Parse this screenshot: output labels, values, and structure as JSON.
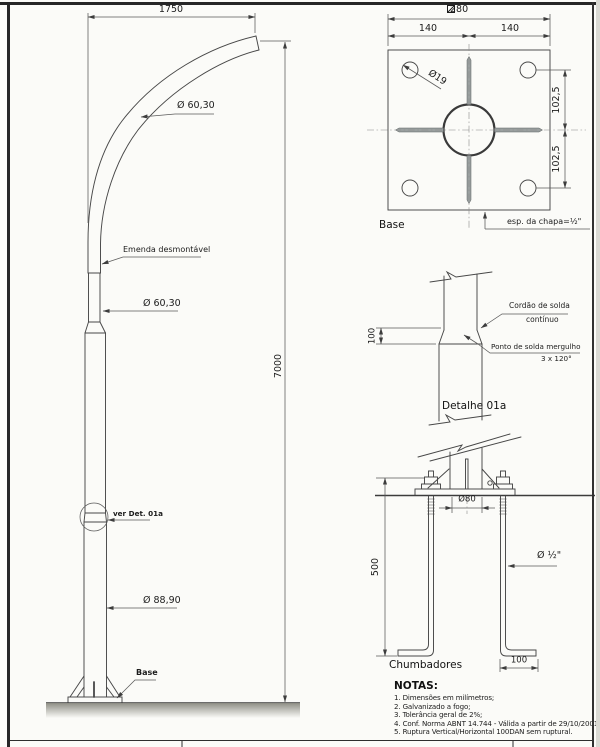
{
  "colors": {
    "line": "#474747",
    "text": "#1c1c1c",
    "slot_fill": "#9aa0a0",
    "paper": "#fbfbf8"
  },
  "pole_view": {
    "dim_width": "1750",
    "dim_height": "7000",
    "arm_diameter": "Ø 60,30",
    "splice_label": "Emenda desmontável",
    "shaft_diameter": "Ø 60,30",
    "detail_ref": "ver Det. 01a",
    "base_diameter": "Ø 88,90",
    "base_label": "Base"
  },
  "base_plate_view": {
    "title": "Base",
    "dim_square": "280",
    "dim_left_half": "140",
    "dim_right_half": "140",
    "hole_diameter": "Ø19",
    "dim_upper_spacing": "102,5",
    "dim_lower_spacing": "102,5",
    "plate_thickness": "esp. da chapa=½\""
  },
  "weld_detail_view": {
    "title": "Detalhe 01a",
    "continuous_weld_line1": "Cordão de solda",
    "continuous_weld_line2": "contínuo",
    "spot_weld_line1": "Ponto de solda mergulho",
    "spot_weld_line2": "3 x 120°",
    "dim_overlap": "100"
  },
  "anchor_bolts_view": {
    "title": "Chumbadores",
    "dim_length": "500",
    "dim_spacing": "Ø80",
    "bolt_diameter": "Ø ½\"",
    "dim_hook": "100"
  },
  "notes": {
    "title": "NOTAS:",
    "items": [
      "1. Dimensões em milímetros;",
      "2. Galvanizado a fogo;",
      "3. Tolerância geral de 2%;",
      "4. Conf. Norma ABNT 14.744 - Válida a partir de 29/10/2001;",
      "5. Ruptura Vertical/Horizontal 100DAN sem ruptural."
    ]
  }
}
